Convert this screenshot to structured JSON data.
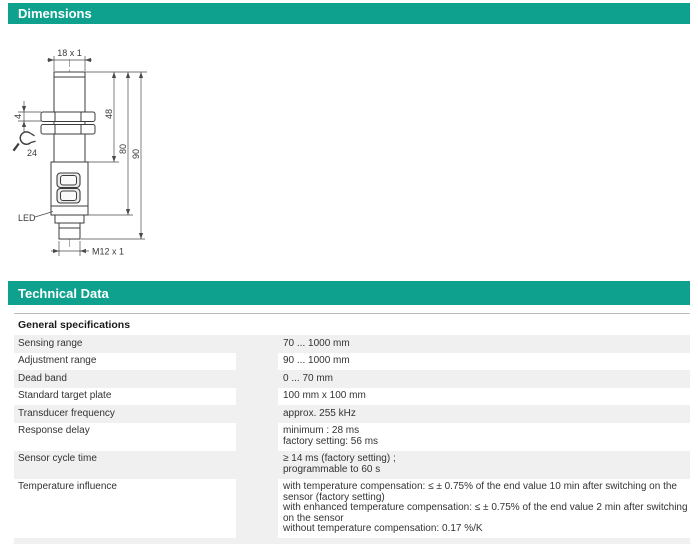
{
  "colors": {
    "accent": "#0da18e",
    "row_stripe": "#f0f0f0",
    "drawing_line": "#3c3c3c"
  },
  "sections": {
    "dimensions": {
      "title": "Dimensions"
    },
    "technical": {
      "title": "Technical Data"
    }
  },
  "drawing": {
    "labels": {
      "thread_top": "18 x 1",
      "nut_thickness": "4",
      "wrench_size": "24",
      "dim_48": "48",
      "dim_80": "80",
      "dim_90": "90",
      "led": "LED",
      "connector": "M12 x 1"
    }
  },
  "table": {
    "section_header": "General specifications",
    "rows": [
      {
        "label": "Sensing range",
        "value": "70 ... 1000 mm"
      },
      {
        "label": "Adjustment range",
        "value": "90 ... 1000 mm"
      },
      {
        "label": "Dead band",
        "value": "0 ... 70 mm"
      },
      {
        "label": "Standard target plate",
        "value": "100 mm x 100 mm"
      },
      {
        "label": "Transducer frequency",
        "value": "approx. 255 kHz"
      },
      {
        "label": "Response delay",
        "value": "minimum : 28 ms\nfactory setting: 56 ms"
      },
      {
        "label": "Sensor cycle time",
        "value": "≥ 14 ms (factory setting) ;\nprogrammable to 60 s"
      },
      {
        "label": "Temperature influence",
        "value": "with temperature compensation: ≤ ± 0.75% of the end value 10 min after switching on the sensor (factory setting)\nwith enhanced temperature compensation: ≤ ± 0.75% of the end value 2 min after switching on the sensor\nwithout temperature compensation: 0.17 %/K"
      }
    ]
  }
}
